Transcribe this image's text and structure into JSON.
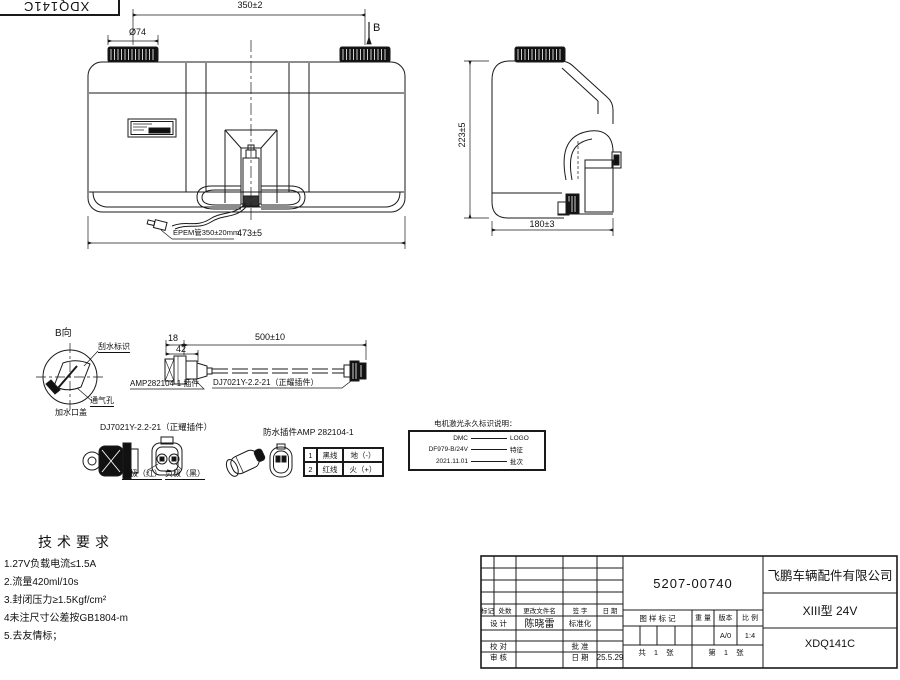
{
  "corner_stamp": {
    "code": "XDQ141C"
  },
  "front_view": {
    "dim_cap_spacing": "350±2",
    "dim_cap_dia": "Ø74",
    "view_label": "B",
    "dim_overall": "473±5",
    "tube_label": "EPEM管350±20mm"
  },
  "side_view": {
    "dim_height": "223±5",
    "dim_depth": "180±3"
  },
  "b_view": {
    "title": "B向",
    "wiper_mark": "刮水标识",
    "vent_hole": "通气孔",
    "filler_cap": "加水口盖"
  },
  "cable": {
    "dim_a": "18",
    "dim_b": "42",
    "dim_len": "500±10",
    "amp_label": "AMP282104-1 插件",
    "dj_label": "DJ7021Y-2.2-21（正耀插件）"
  },
  "connector_detail": {
    "dj_title": "DJ7021Y-2.2-21（正耀插件）",
    "positive": "正极（红）",
    "negative": "负极（黑）",
    "amp_title": "防水插件AMP 282104-1",
    "pin_table": [
      [
        "1",
        "黑线",
        "地（-）"
      ],
      [
        "2",
        "红线",
        "火（+）"
      ]
    ]
  },
  "marking_note": {
    "title": "电机激光永久标识说明：",
    "rows": [
      [
        "DMC",
        "LOGO"
      ],
      [
        "DF979-B/24V",
        "特征"
      ],
      [
        "2021.11.01",
        "批次"
      ]
    ]
  },
  "tech": {
    "title": "技术要求",
    "items": [
      "1.27V负载电流≤1.5A",
      "2.流量420ml/10s",
      "3.封闭压力≥1.5Kgf/cm²",
      "4未注尺寸公差按GB1804-m",
      "5.去友情标；"
    ]
  },
  "title_block": {
    "part_number": "5207-00740",
    "company": "飞鹏车辆配件有限公司",
    "model": "XIII型 24V",
    "drawing_number": "XDQ141C",
    "rev_header": [
      "标记",
      "处数",
      "更改文件名",
      "签 字",
      "日 期"
    ],
    "design_label": "设 计",
    "designer": "陈晓雷",
    "standardization_label": "标准化",
    "check_label": "校 对",
    "approve_label": "批 准",
    "review_label": "审 核",
    "date_label": "日 期",
    "date_value": "25.5.29",
    "mark_label": "图 样 标 记",
    "weight_label": "重 量",
    "version_label": "版本",
    "scale_label": "比 例",
    "version_value": "A/0",
    "scale_value": "1:4",
    "sheets_total": "共 1 张",
    "sheet_number": "第 1 张"
  }
}
